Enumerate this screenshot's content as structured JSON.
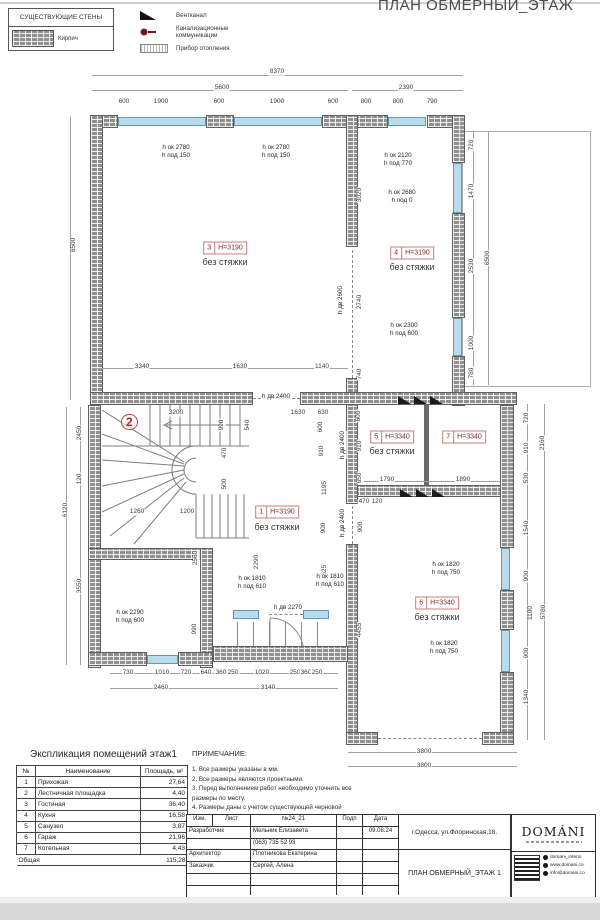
{
  "header": {
    "title": "ПЛАН ОБМЕРНЫЙ_ЭТАЖ"
  },
  "legend": {
    "walls_title": "СУЩЕСТВУЮЩИЕ СТЕНЫ",
    "brick_label": "Кирпич",
    "symbols": [
      {
        "label": "Вентканал"
      },
      {
        "label": "Канализационные коммуникации"
      },
      {
        "label": "Прибор отопления"
      }
    ]
  },
  "plan": {
    "stair_mark": "2",
    "rooms": [
      {
        "num": "3",
        "h": "H=3190",
        "note": "без стяжки",
        "x": 225,
        "y": 248,
        "ny": 262
      },
      {
        "num": "4",
        "h": "H=3190",
        "note": "без стяжки",
        "x": 412,
        "y": 253,
        "ny": 267
      },
      {
        "num": "1",
        "h": "H=3190",
        "note": "без стяжки",
        "x": 277,
        "y": 512,
        "ny": 527
      },
      {
        "num": "5",
        "h": "H=3340",
        "note": "без стяжки",
        "x": 392,
        "y": 437,
        "ny": 451
      },
      {
        "num": "7",
        "h": "H=3340",
        "note": "",
        "x": 464,
        "y": 437,
        "ny": 0
      },
      {
        "num": "6",
        "h": "H=3340",
        "note": "без стяжки",
        "x": 437,
        "y": 603,
        "ny": 617
      }
    ],
    "openings": [
      {
        "t1": "h ок 2780",
        "t2": "h под 150",
        "x": 176,
        "y": 152,
        "v": 0
      },
      {
        "t1": "h ок 2780",
        "t2": "h под 150",
        "x": 276,
        "y": 152,
        "v": 0
      },
      {
        "t1": "h ок 2120",
        "t2": "h под 770",
        "x": 398,
        "y": 160,
        "v": 0
      },
      {
        "t1": "h ок 2680",
        "t2": "h под 0",
        "x": 402,
        "y": 197,
        "v": 0
      },
      {
        "t1": "h ок 2300",
        "t2": "h под 600",
        "x": 404,
        "y": 330,
        "v": 0
      },
      {
        "t1": "h ок 1810",
        "t2": "h под 610",
        "x": 252,
        "y": 583,
        "v": 0
      },
      {
        "t1": "h ок 1810",
        "t2": "h под 610",
        "x": 330,
        "y": 581,
        "v": 0
      },
      {
        "t1": "h дв 2270",
        "t2": "",
        "x": 288,
        "y": 608,
        "v": 0
      },
      {
        "t1": "h ок 2290",
        "t2": "h под 600",
        "x": 130,
        "y": 617,
        "v": 0
      },
      {
        "t1": "h ок 1820",
        "t2": "h под 750",
        "x": 446,
        "y": 569,
        "v": 0
      },
      {
        "t1": "h ок 1820",
        "t2": "h под 750",
        "x": 444,
        "y": 648,
        "v": 0
      },
      {
        "t1": "h дв 2400",
        "t2": "",
        "x": 276,
        "y": 397,
        "v": 0
      },
      {
        "t1": "h дв 2400",
        "t2": "",
        "x": 343,
        "y": 445,
        "v": 1
      },
      {
        "t1": "h дв 2400",
        "t2": "",
        "x": 343,
        "y": 523,
        "v": 1
      },
      {
        "t1": "h дв 2600",
        "t2": "",
        "x": 341,
        "y": 300,
        "v": 1
      }
    ],
    "dims": [
      [
        "8370",
        277,
        72,
        0
      ],
      [
        "5600",
        222,
        88,
        0
      ],
      [
        "2390",
        406,
        88,
        0
      ],
      [
        "600",
        124,
        102,
        0
      ],
      [
        "1900",
        161,
        102,
        0
      ],
      [
        "600",
        219,
        102,
        0
      ],
      [
        "1900",
        277,
        102,
        0
      ],
      [
        "600",
        333,
        102,
        0
      ],
      [
        "800",
        366,
        102,
        0
      ],
      [
        "800",
        398,
        102,
        0
      ],
      [
        "790",
        432,
        102,
        0
      ],
      [
        "6500",
        74,
        245,
        1
      ],
      [
        "2450",
        80,
        433,
        1
      ],
      [
        "120",
        80,
        479,
        1
      ],
      [
        "3550",
        80,
        586,
        1
      ],
      [
        "6120",
        66,
        510,
        1
      ],
      [
        "3020",
        360,
        195,
        1
      ],
      [
        "2740",
        360,
        302,
        1
      ],
      [
        "740",
        360,
        374,
        1
      ],
      [
        "720",
        472,
        145,
        1
      ],
      [
        "1470",
        472,
        191,
        1
      ],
      [
        "2530",
        472,
        266,
        1
      ],
      [
        "1000",
        472,
        343,
        1
      ],
      [
        "780",
        472,
        373,
        1
      ],
      [
        "6500",
        488,
        258,
        1
      ],
      [
        "3340",
        142,
        367,
        0
      ],
      [
        "1630",
        240,
        367,
        0
      ],
      [
        "1140",
        322,
        367,
        0
      ],
      [
        "3200",
        176,
        413,
        0
      ],
      [
        "990",
        222,
        425,
        1
      ],
      [
        "470",
        225,
        453,
        1
      ],
      [
        "500",
        225,
        484,
        1
      ],
      [
        "1260",
        137,
        512,
        0
      ],
      [
        "1200",
        187,
        512,
        0
      ],
      [
        "2560",
        196,
        558,
        1
      ],
      [
        "2290",
        257,
        562,
        1
      ],
      [
        "1630",
        298,
        413,
        0
      ],
      [
        "630",
        323,
        413,
        0
      ],
      [
        "540",
        248,
        425,
        1
      ],
      [
        "600",
        321,
        427,
        1
      ],
      [
        "910",
        322,
        451,
        1
      ],
      [
        "1195",
        325,
        488,
        1
      ],
      [
        "900",
        324,
        528,
        1
      ],
      [
        "1525",
        325,
        572,
        1
      ],
      [
        "990",
        195,
        629,
        1
      ],
      [
        "730",
        128,
        673,
        0
      ],
      [
        "1010",
        162,
        673,
        0
      ],
      [
        "720",
        186,
        673,
        0
      ],
      [
        "640",
        206,
        673,
        0
      ],
      [
        "360",
        221,
        673,
        0
      ],
      [
        "250",
        233,
        673,
        0
      ],
      [
        "1020",
        262,
        673,
        0
      ],
      [
        "250",
        295,
        673,
        0
      ],
      [
        "360",
        306,
        673,
        0
      ],
      [
        "250",
        317,
        673,
        0
      ],
      [
        "2460",
        161,
        688,
        0
      ],
      [
        "3140",
        268,
        688,
        0
      ],
      [
        "600",
        359,
        416,
        1
      ],
      [
        "910",
        360,
        446,
        1
      ],
      [
        "650",
        360,
        478,
        1
      ],
      [
        "1790",
        387,
        480,
        0
      ],
      [
        "1890",
        463,
        480,
        0
      ],
      [
        "720",
        527,
        418,
        1
      ],
      [
        "910",
        527,
        448,
        1
      ],
      [
        "530",
        527,
        478,
        1
      ],
      [
        "2160",
        543,
        443,
        1
      ],
      [
        "470",
        364,
        502,
        0
      ],
      [
        "120",
        377,
        502,
        0
      ],
      [
        "900",
        361,
        527,
        1
      ],
      [
        "4455",
        360,
        630,
        1
      ],
      [
        "1540",
        527,
        528,
        1
      ],
      [
        "900",
        527,
        576,
        1
      ],
      [
        "1100",
        531,
        613,
        1
      ],
      [
        "900",
        527,
        653,
        1
      ],
      [
        "1340",
        527,
        697,
        1
      ],
      [
        "5780",
        544,
        612,
        1
      ],
      [
        "3800",
        424,
        752,
        0
      ],
      [
        "3800",
        424,
        766,
        0
      ]
    ]
  },
  "schedule": {
    "title": "Экспликация помещений этаж1",
    "col_num": "№",
    "col_name": "Наименование",
    "col_area": "Площадь, м²",
    "rows": [
      [
        "1",
        "Прихожая",
        "27,64"
      ],
      [
        "2",
        "Лестничная площадка",
        "4,40"
      ],
      [
        "3",
        "Гостиная",
        "36,40"
      ],
      [
        "4",
        "Кухня",
        "16,58"
      ],
      [
        "5",
        "Санузел",
        "3,87"
      ],
      [
        "6",
        "Гараж",
        "21,96"
      ],
      [
        "7",
        "Котельная",
        "4,43"
      ]
    ],
    "total_label": "Общая",
    "total_value": "115,28"
  },
  "notes": {
    "title": "ПРИМЕЧАНИЕ:",
    "items": [
      "1. Все размеры указаны в мм.",
      "2. Все размеры являются проектными.",
      "3. Перед выполнением работ необходимо уточнить все размеры по месту.",
      "4. Размеры даны с учетом существующей черновой стяжки."
    ]
  },
  "titleblock": {
    "col_izm": "Изм.",
    "col_list": "Лист",
    "col_num": "№24_21",
    "col_podp": "Подп",
    "col_date": "Дата",
    "rows": [
      {
        "role": "Разработчик",
        "value": "Мельник Елизавета",
        "date": "09.08.24"
      },
      {
        "role": "",
        "value": "(063) 735 52 93",
        "date": ""
      },
      {
        "role": "Архитектор",
        "value": "Плотникова Екатерина",
        "date": ""
      },
      {
        "role": "Заказчик",
        "value": "Сергей, Алена",
        "date": ""
      }
    ],
    "address": "г.Одесса, ул.Флоринская,18.",
    "sheet_title": "ПЛАН ОБМЕРНЫЙ_ЭТАЖ 1"
  },
  "brand": {
    "logo": "DOMÁNI",
    "contacts": [
      "domani_interio",
      "www.domani.co",
      "info@domani.co"
    ]
  }
}
